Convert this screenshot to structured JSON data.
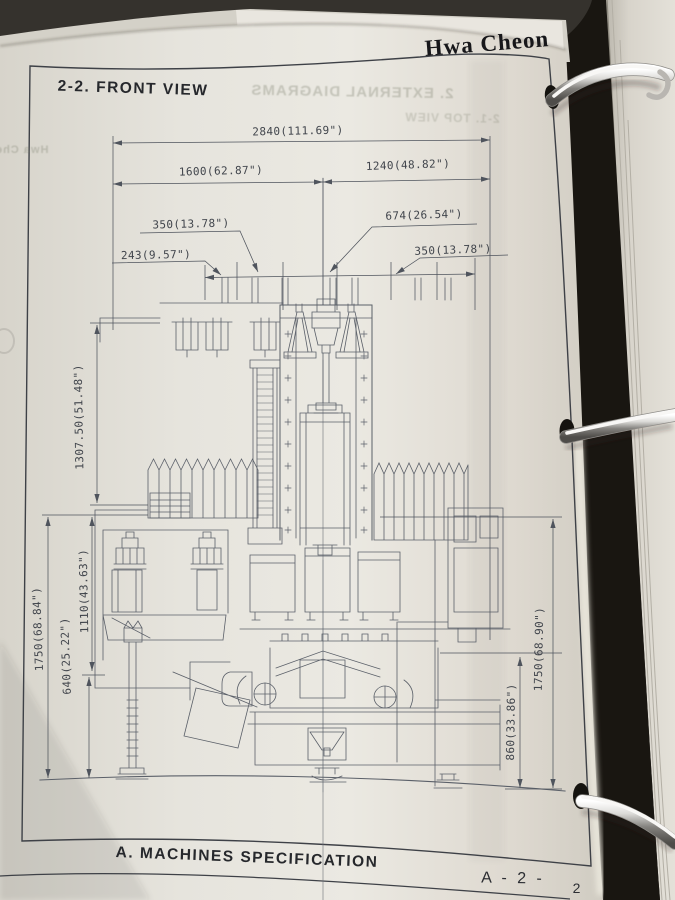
{
  "header": {
    "brand": "Hwa Cheon"
  },
  "page": {
    "section_title": "2-2. FRONT VIEW",
    "footer_title": "A. MACHINES SPECIFICATION",
    "page_code": "A - 2 -",
    "page_number": "2"
  },
  "bleedthrough": {
    "line1": "2. EXTERNAL DIAGRAMS",
    "line2": "2-1. TOP VIEW",
    "left_edge": "Hwa Cheon"
  },
  "dimensions": {
    "overall_width": "2840(111.69\")",
    "left_span": "1600(62.87\")",
    "right_span": "1240(48.82\")",
    "left_offset": "350(13.78\")",
    "head_width": "674(26.54\")",
    "far_left_offset": "243(9.57\")",
    "right_offset": "350(13.78\")",
    "column_height": "1307.50(51.48\")",
    "mid_height": "1110(43.63\")",
    "lower_height": "640(25.22\")",
    "total_height_left": "1750(68.84\")",
    "total_height_right": "1750(68.90\")",
    "base_height": "860(33.86\")"
  }
}
